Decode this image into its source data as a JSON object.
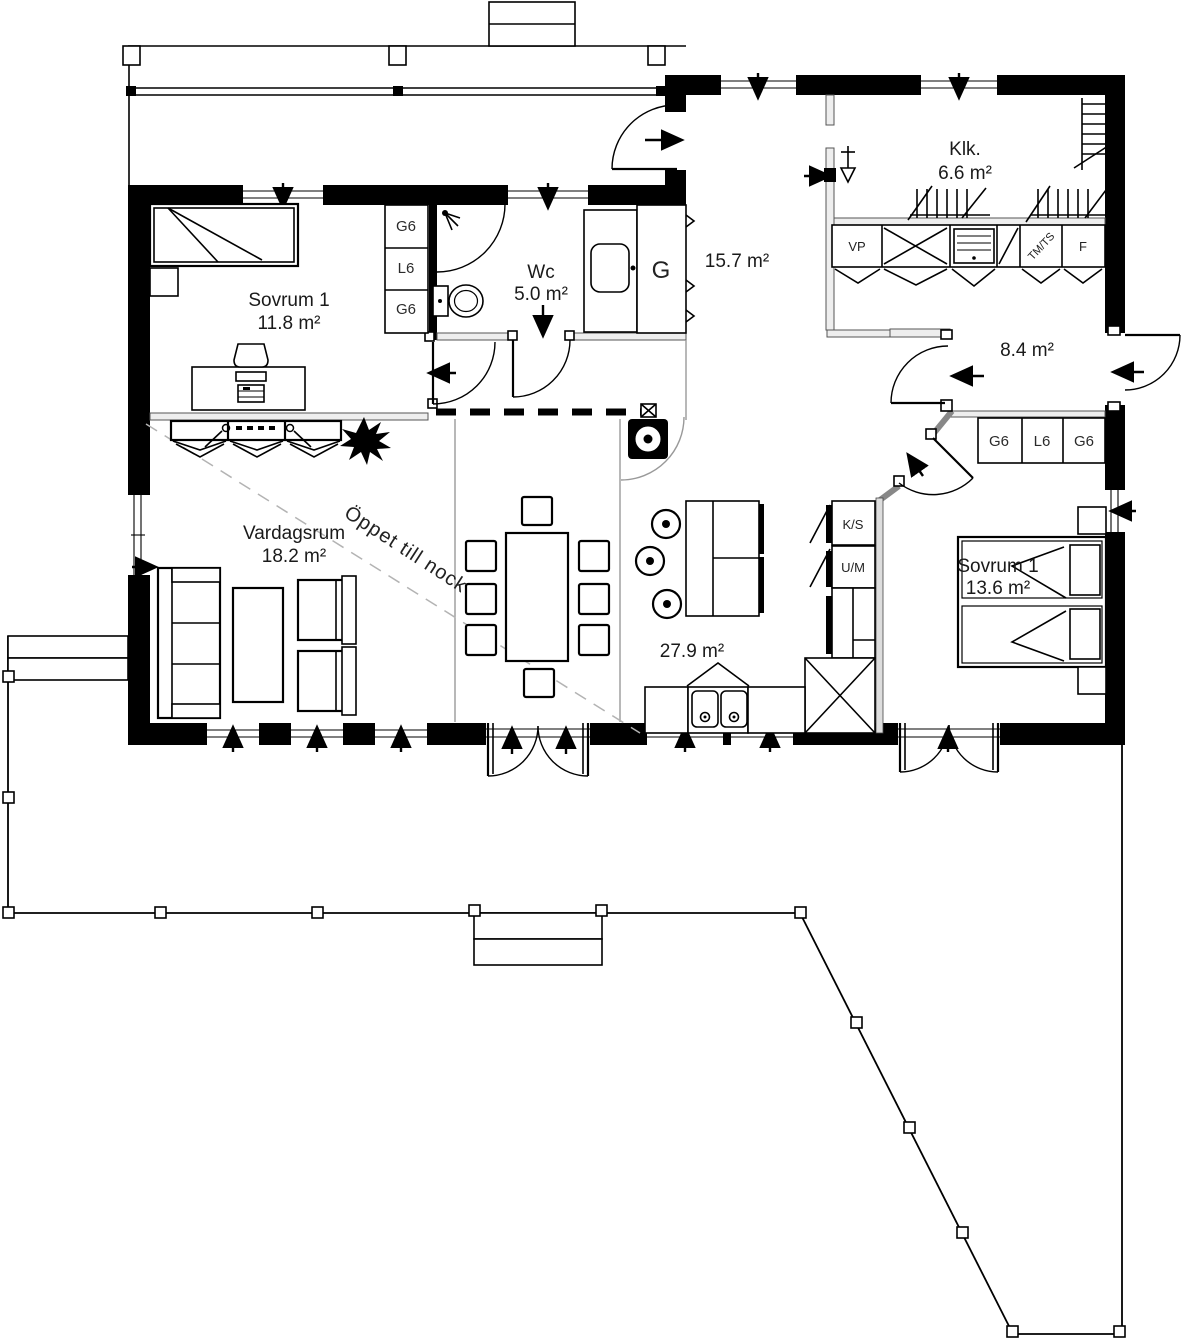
{
  "plan": {
    "rooms": {
      "sovrum1": {
        "name": "Sovrum 1",
        "area": "11.8 m²"
      },
      "wc": {
        "name": "Wc",
        "area": "5.0 m²"
      },
      "hall_entry": {
        "area": "15.7 m²"
      },
      "klk": {
        "name": "Klk.",
        "area": "6.6 m²"
      },
      "hall_back": {
        "area": "8.4 m²"
      },
      "sovrum2": {
        "name": "Sovrum 1",
        "area": "13.6 m²"
      },
      "vardagsrum": {
        "name": "Vardagsrum",
        "area": "18.2 m²"
      },
      "kitchen_dining": {
        "area": "27.9 m²"
      }
    },
    "annotations": {
      "open_to_ridge": "Öppet till nock"
    },
    "cabinets": {
      "bedroom1_closets": [
        "G6",
        "L6",
        "G6"
      ],
      "hall_closets": [
        "G6",
        "L6",
        "G6"
      ],
      "hall_wardrobe": "G",
      "utility_row": {
        "vp": "VP",
        "tm_ts": "TM/TS",
        "f": "F"
      },
      "kitchen_units": {
        "ks": "K/S",
        "um": "U/M"
      }
    },
    "colors": {
      "walls": "#000000",
      "partitions": "#555555",
      "guide_dash": "#b3b3b3"
    }
  }
}
